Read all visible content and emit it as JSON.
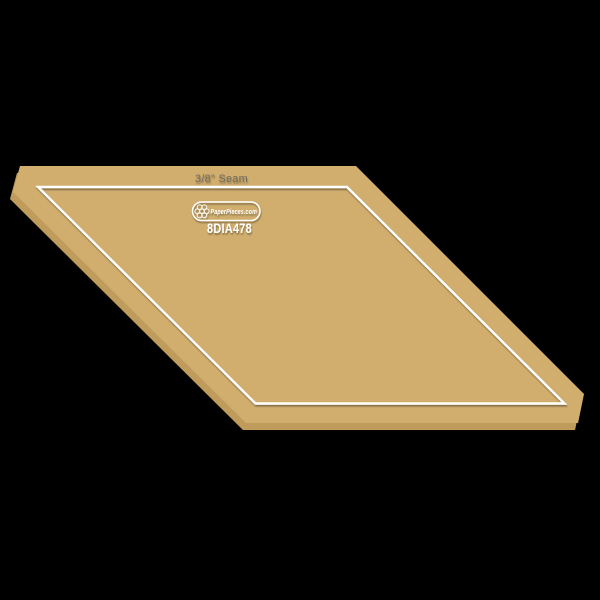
{
  "product": {
    "seam_label": "3/8\" Seam",
    "brand_label": "PaperPieces.com",
    "product_code": "8DIA478"
  },
  "colors": {
    "background": "#000000",
    "acrylic_face": "#d1ae6e",
    "acrylic_side": "#bf9c5c",
    "marking_white": "#ffffff",
    "seam_label_text": "#6f6b60"
  }
}
